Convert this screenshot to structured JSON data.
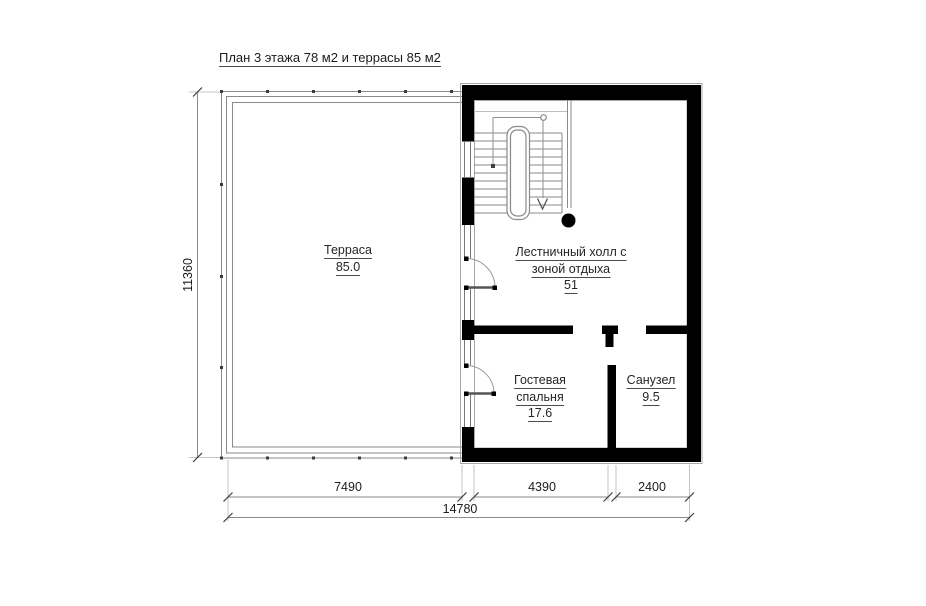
{
  "title": "План 3 этажа 78 м2 и террасы 85 м2",
  "rooms": {
    "terrace": {
      "name": "Терраса",
      "area": "85.0"
    },
    "hall": {
      "name_line1": "Лестничный холл с",
      "name_line2": "зоной отдыха",
      "area": "51"
    },
    "bedroom": {
      "name_line1": "Гостевая",
      "name_line2": "спальня",
      "area": "17.6"
    },
    "bathroom": {
      "name": "Санузел",
      "area": "9.5"
    }
  },
  "dimensions": {
    "bottom_segments": [
      "7490",
      "4390",
      "2400"
    ],
    "bottom_total": "14780",
    "left_height": "11360"
  },
  "colors": {
    "wall": "#000000",
    "thin_line": "#8a8a8a",
    "extension_line": "#bdbdbd",
    "text": "#1c1c1c"
  }
}
